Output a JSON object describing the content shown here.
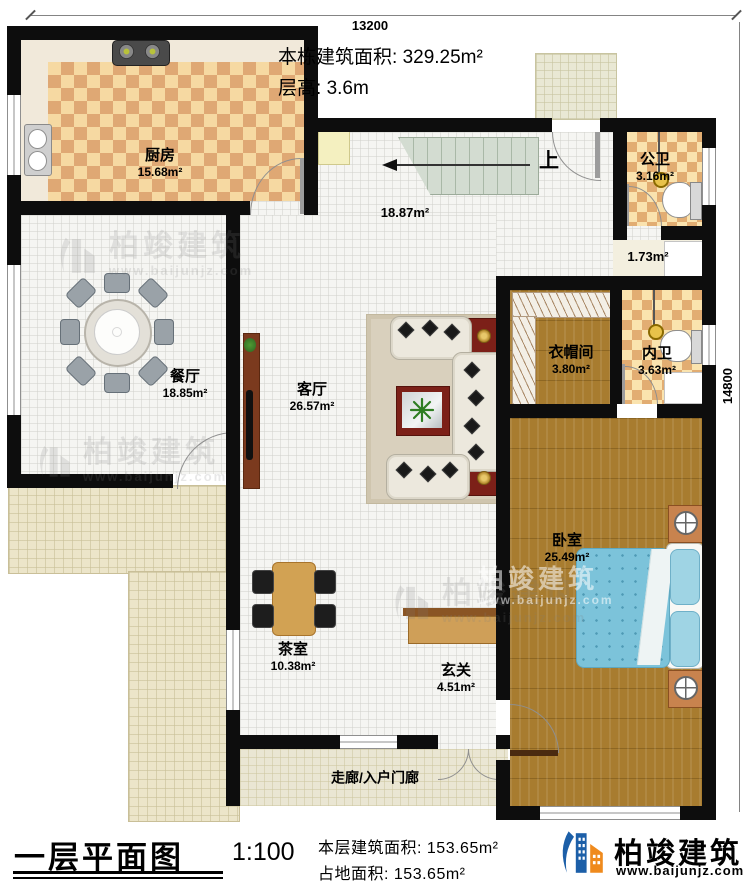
{
  "dimensions": {
    "top": "13200",
    "right": "14800"
  },
  "header": {
    "building_area_label": "本栋建筑面积:",
    "building_area_value": "329.25m²",
    "floor_height_label": "层高:",
    "floor_height_value": "3.6m"
  },
  "stair": {
    "up_label": "上"
  },
  "rooms": {
    "kitchen": {
      "name": "厨房",
      "area": "15.68m²"
    },
    "public_bath": {
      "name": "公卫",
      "area": "3.16m²"
    },
    "hall": {
      "area": "18.87m²"
    },
    "basin": {
      "area": "1.73m²"
    },
    "dining": {
      "name": "餐厅",
      "area": "18.85m²"
    },
    "living": {
      "name": "客厅",
      "area": "26.57m²"
    },
    "cloakroom": {
      "name": "衣帽间",
      "area": "3.80m²"
    },
    "inner_bath": {
      "name": "内卫",
      "area": "3.63m²"
    },
    "bedroom": {
      "name": "卧室",
      "area": "25.49m²"
    },
    "tea_room": {
      "name": "茶室",
      "area": "10.38m²"
    },
    "foyer": {
      "name": "玄关",
      "area": "4.51m²"
    },
    "corridor": {
      "name": "走廊/入户门廊"
    }
  },
  "footer": {
    "title": "一层平面图",
    "scale": "1:100",
    "floor_area_label": "本层建筑面积:",
    "floor_area_value": "153.65m²",
    "land_area_label": "占地面积:",
    "land_area_value": "153.65m²"
  },
  "brand": {
    "name": "柏竣建筑",
    "url": "www.baijunjz.com"
  },
  "colors": {
    "wall": "#0d0d0d",
    "brand_blue": "#1c5fa8",
    "brand_orange": "#ef8a1d",
    "kitchen_checker": "#dfa874",
    "wood_floor": "#a87c2f",
    "bed_blue": "#7cc3da"
  }
}
